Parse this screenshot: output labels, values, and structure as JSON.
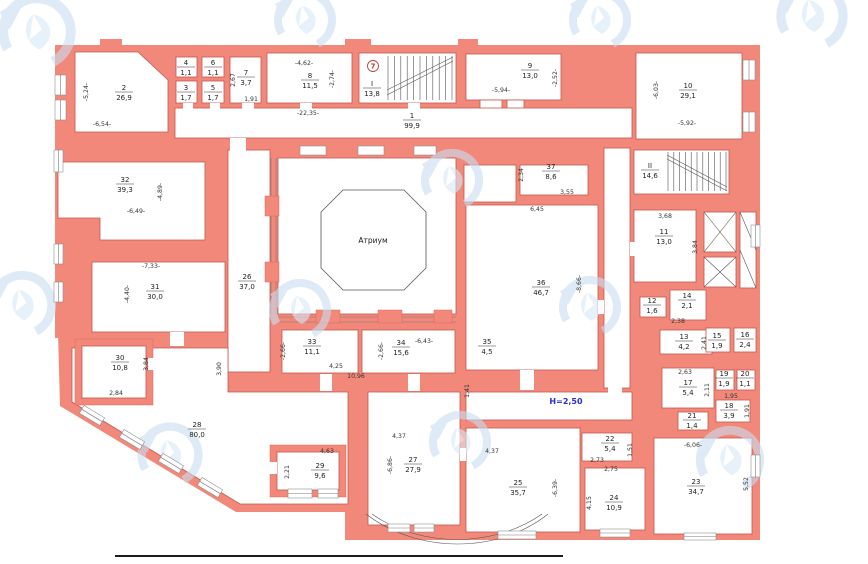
{
  "labels": {
    "atrium": "Атриум",
    "height": "Н=2,50",
    "stair_marker": "7"
  },
  "colors": {
    "wall": "#f2887a",
    "wall_edge": "#c4574e",
    "watermark": "#cfe3f4",
    "height_blue": "#2b2bd6",
    "marker_red": "#c0392b"
  },
  "rooms": [
    {
      "n": "1",
      "a": "99,9",
      "x": 412,
      "y": 120
    },
    {
      "n": "2",
      "a": "26,9",
      "x": 124,
      "y": 92
    },
    {
      "n": "3",
      "a": "1,7",
      "x": 186,
      "y": 92
    },
    {
      "n": "4",
      "a": "1,1",
      "x": 186,
      "y": 67
    },
    {
      "n": "5",
      "a": "1,7",
      "x": 213,
      "y": 92
    },
    {
      "n": "6",
      "a": "1,1",
      "x": 213,
      "y": 67
    },
    {
      "n": "7",
      "a": "3,7",
      "x": 246,
      "y": 77
    },
    {
      "n": "8",
      "a": "11,5",
      "x": 310,
      "y": 80
    },
    {
      "n": "9",
      "a": "13,0",
      "x": 530,
      "y": 70
    },
    {
      "n": "10",
      "a": "29,1",
      "x": 688,
      "y": 90
    },
    {
      "n": "I",
      "a": "13,8",
      "x": 372,
      "y": 88
    },
    {
      "n": "II",
      "a": "14,6",
      "x": 650,
      "y": 170
    },
    {
      "n": "11",
      "a": "13,0",
      "x": 664,
      "y": 236
    },
    {
      "n": "12",
      "a": "1,6",
      "x": 652,
      "y": 305
    },
    {
      "n": "13",
      "a": "4,2",
      "x": 684,
      "y": 341
    },
    {
      "n": "14",
      "a": "2,1",
      "x": 687,
      "y": 300
    },
    {
      "n": "15",
      "a": "1,9",
      "x": 717,
      "y": 340
    },
    {
      "n": "16",
      "a": "2,4",
      "x": 745,
      "y": 339
    },
    {
      "n": "17",
      "a": "5,4",
      "x": 688,
      "y": 387
    },
    {
      "n": "18",
      "a": "3,9",
      "x": 729,
      "y": 410
    },
    {
      "n": "19",
      "a": "1,9",
      "x": 724,
      "y": 378
    },
    {
      "n": "20",
      "a": "1,1",
      "x": 745,
      "y": 378
    },
    {
      "n": "21",
      "a": "1,4",
      "x": 692,
      "y": 420
    },
    {
      "n": "22",
      "a": "5,4",
      "x": 610,
      "y": 443
    },
    {
      "n": "23",
      "a": "34,7",
      "x": 696,
      "y": 486
    },
    {
      "n": "24",
      "a": "10,9",
      "x": 614,
      "y": 502
    },
    {
      "n": "25",
      "a": "35,7",
      "x": 518,
      "y": 487
    },
    {
      "n": "26",
      "a": "37,0",
      "x": 247,
      "y": 281
    },
    {
      "n": "27",
      "a": "27,9",
      "x": 413,
      "y": 464
    },
    {
      "n": "28",
      "a": "80,0",
      "x": 197,
      "y": 429
    },
    {
      "n": "29",
      "a": "9,6",
      "x": 320,
      "y": 470
    },
    {
      "n": "30",
      "a": "10,8",
      "x": 120,
      "y": 362
    },
    {
      "n": "31",
      "a": "30,0",
      "x": 155,
      "y": 291
    },
    {
      "n": "32",
      "a": "39,3",
      "x": 125,
      "y": 184
    },
    {
      "n": "33",
      "a": "11,1",
      "x": 312,
      "y": 346
    },
    {
      "n": "34",
      "a": "15,6",
      "x": 401,
      "y": 347
    },
    {
      "n": "35",
      "a": "4,5",
      "x": 487,
      "y": 346
    },
    {
      "n": "36",
      "a": "46,7",
      "x": 541,
      "y": 287
    },
    {
      "n": "37",
      "a": "8,6",
      "x": 551,
      "y": 171
    }
  ],
  "dims": [
    {
      "t": "-5,24-",
      "x": 88,
      "y": 92,
      "r": -90
    },
    {
      "t": "-6,54-",
      "x": 102,
      "y": 126,
      "r": 0
    },
    {
      "t": "2,67",
      "x": 235,
      "y": 80,
      "r": -90
    },
    {
      "t": "1,91",
      "x": 251,
      "y": 101,
      "r": 0
    },
    {
      "t": "-4,62-",
      "x": 304,
      "y": 65,
      "r": 0
    },
    {
      "t": "-2,74-",
      "x": 334,
      "y": 79,
      "r": -90
    },
    {
      "t": "-22,35-",
      "x": 308,
      "y": 115,
      "r": 0
    },
    {
      "t": "-5,94-",
      "x": 501,
      "y": 92,
      "r": 0
    },
    {
      "t": "-2,52-",
      "x": 557,
      "y": 78,
      "r": -90
    },
    {
      "t": "-6,03-",
      "x": 658,
      "y": 90,
      "r": -90
    },
    {
      "t": "-5,92-",
      "x": 687,
      "y": 125,
      "r": 0
    },
    {
      "t": "-6,49-",
      "x": 136,
      "y": 213,
      "r": 0
    },
    {
      "t": "-4,89-",
      "x": 162,
      "y": 192,
      "r": -90
    },
    {
      "t": "-7,33-",
      "x": 151,
      "y": 268,
      "r": 0
    },
    {
      "t": "-4,40-",
      "x": 129,
      "y": 294,
      "r": -90
    },
    {
      "t": "3,90",
      "x": 221,
      "y": 369,
      "r": -90
    },
    {
      "t": "2,84",
      "x": 116,
      "y": 395,
      "r": 0
    },
    {
      "t": "3,84",
      "x": 148,
      "y": 364,
      "r": -90
    },
    {
      "t": "4,63",
      "x": 327,
      "y": 453,
      "r": 0
    },
    {
      "t": "2,21",
      "x": 289,
      "y": 472,
      "r": -90
    },
    {
      "t": "-6,86-",
      "x": 392,
      "y": 465,
      "r": -90
    },
    {
      "t": "4,37",
      "x": 399,
      "y": 438,
      "r": 0
    },
    {
      "t": "4,37",
      "x": 492,
      "y": 453,
      "r": 0
    },
    {
      "t": "-6,39-",
      "x": 557,
      "y": 488,
      "r": -90
    },
    {
      "t": "4,15",
      "x": 591,
      "y": 503,
      "r": -90
    },
    {
      "t": "2,73",
      "x": 597,
      "y": 462,
      "r": 0
    },
    {
      "t": "2,75",
      "x": 611,
      "y": 471,
      "r": 0
    },
    {
      "t": "1,51",
      "x": 632,
      "y": 450,
      "r": -90
    },
    {
      "t": "-6,06-",
      "x": 693,
      "y": 447,
      "r": 0
    },
    {
      "t": "5,52",
      "x": 748,
      "y": 484,
      "r": -90
    },
    {
      "t": "2,63",
      "x": 685,
      "y": 374,
      "r": 0
    },
    {
      "t": "2,11",
      "x": 709,
      "y": 390,
      "r": -90
    },
    {
      "t": "1,95",
      "x": 731,
      "y": 398,
      "r": 0
    },
    {
      "t": "1,91",
      "x": 749,
      "y": 411,
      "r": -90
    },
    {
      "t": "2,38",
      "x": 678,
      "y": 323,
      "r": 0
    },
    {
      "t": "2,41",
      "x": 706,
      "y": 343,
      "r": -90
    },
    {
      "t": "3,68",
      "x": 665,
      "y": 218,
      "r": 0
    },
    {
      "t": "3,84",
      "x": 697,
      "y": 247,
      "r": -90
    },
    {
      "t": "-8,66-",
      "x": 581,
      "y": 284,
      "r": -90
    },
    {
      "t": "6,45",
      "x": 537,
      "y": 211,
      "r": 0
    },
    {
      "t": "3,55",
      "x": 567,
      "y": 194,
      "r": 0
    },
    {
      "t": "2,34",
      "x": 523,
      "y": 175,
      "r": -90
    },
    {
      "t": "-2,66-",
      "x": 285,
      "y": 351,
      "r": -90
    },
    {
      "t": "4,25",
      "x": 336,
      "y": 368,
      "r": 0
    },
    {
      "t": "10,96",
      "x": 356,
      "y": 378,
      "r": 0
    },
    {
      "t": "-2,66-",
      "x": 383,
      "y": 351,
      "r": -90
    },
    {
      "t": "-6,43-",
      "x": 424,
      "y": 343,
      "r": 0
    },
    {
      "t": "1,41",
      "x": 469,
      "y": 391,
      "r": -90
    }
  ]
}
